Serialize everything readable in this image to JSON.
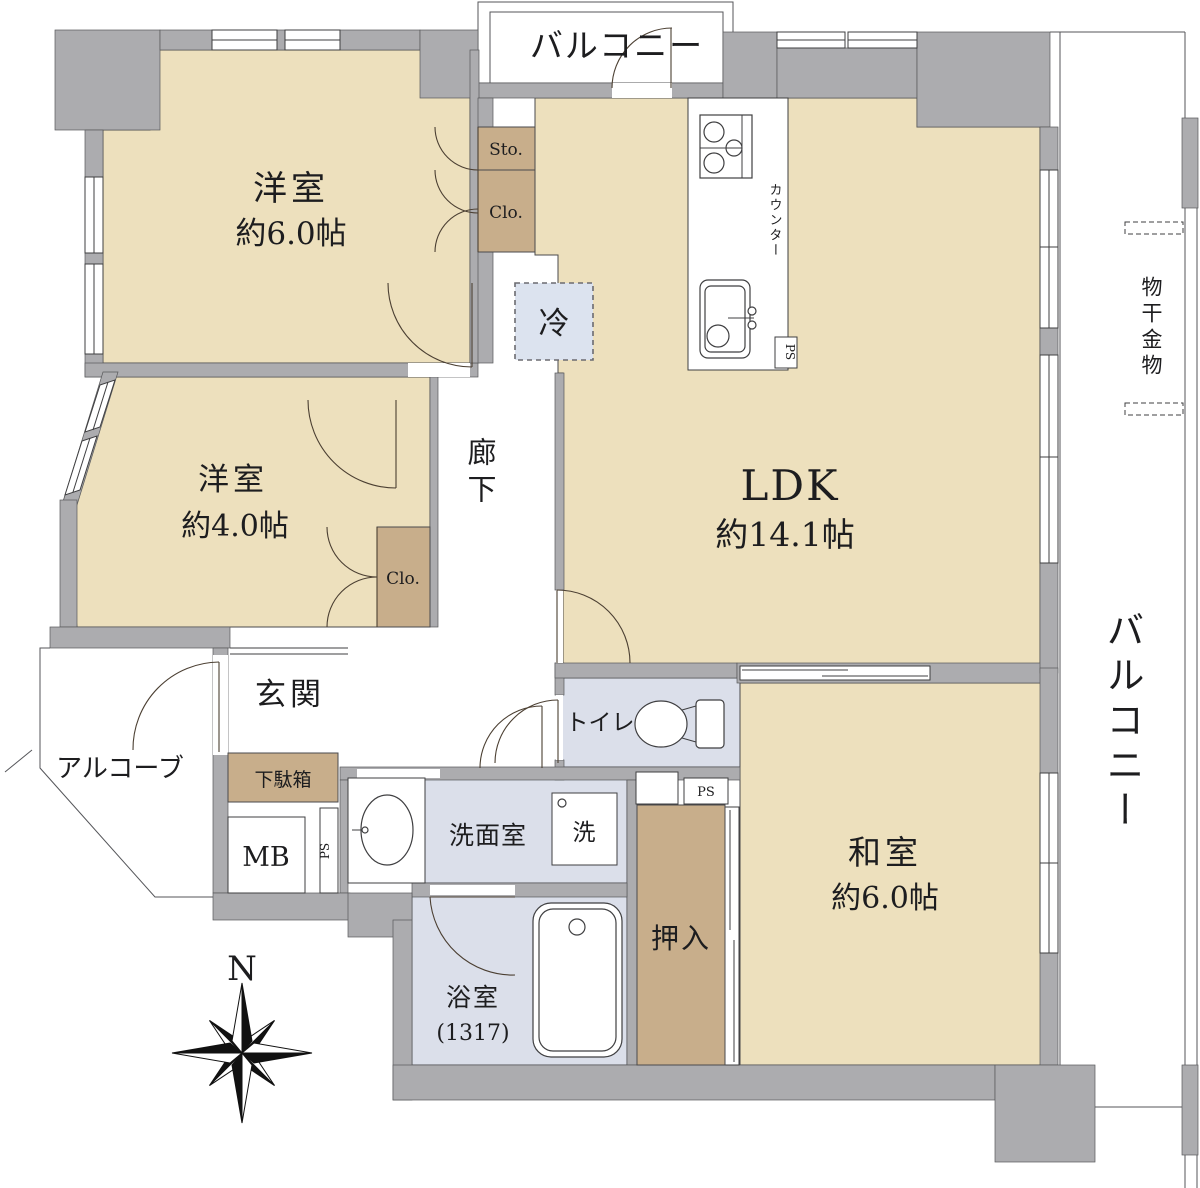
{
  "labels": {
    "room1_name": "洋室",
    "room1_size": "約6.0帖",
    "room2_name": "洋室",
    "room2_size": "約4.0帖",
    "ldk_name": "LDK",
    "ldk_size": "約14.1帖",
    "washitsu_name": "和室",
    "washitsu_size": "約6.0帖",
    "corridor": "廊下",
    "entrance": "玄関",
    "alcove": "アルコーブ",
    "washroom": "洗面室",
    "bath_name": "浴室",
    "bath_size": "(1317)",
    "toilet": "トイレ",
    "balcony_top": "バルコニー",
    "balcony_right": "バルコニー",
    "laundry_hardware": "物干金物",
    "counter": "カウンター",
    "fridge": "冷",
    "washer": "洗",
    "sto": "Sto.",
    "clo1": "Clo.",
    "clo2": "Clo.",
    "oshiire": "押入",
    "getabako": "下駄箱",
    "mb": "MB",
    "ps_kitchen": "PS",
    "ps_toilet": "PS",
    "ps_entry": "PS",
    "north": "N"
  },
  "colors": {
    "wall": "#ACACAF",
    "room_fill": "#EDE0BD",
    "closet_fill": "#C8AE8B",
    "wet_fill": "#DBDFEA",
    "line": "#3F3F41"
  }
}
